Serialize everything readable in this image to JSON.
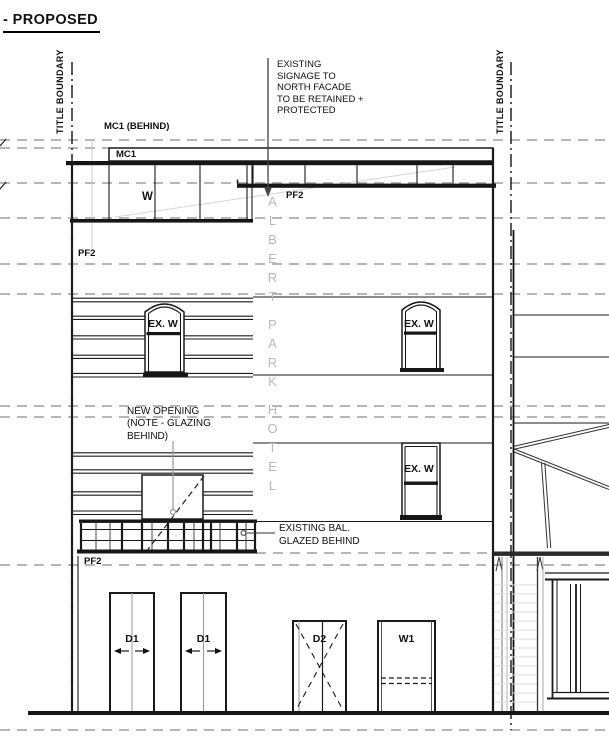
{
  "title": "- PROPOSED",
  "boundary": {
    "left": "TITLE BOUNDARY",
    "right": "TITLE BOUNDARY"
  },
  "notes": {
    "signage": "EXISTING\nSIGNAGE TO\nNORTH FACADE\nTO BE RETAINED +\nPROTECTED",
    "mc1_behind": "MC1 (BEHIND)",
    "new_opening": "NEW OPENING\n(NOTE - GLAZING\nBEHIND)",
    "existing_bal": "EXISTING BAL.\nGLAZED BEHIND"
  },
  "tags": {
    "mc1": "MC1",
    "w": "W",
    "pf2": "PF2",
    "ex_w": "EX. W",
    "d1": "D1",
    "d2": "D2",
    "w1": "W1"
  },
  "building_sign": {
    "word1": "ALBERT",
    "word2": "PARK",
    "word3": "HOTEL"
  },
  "colors": {
    "line": "#1a1a1a",
    "datum_gray": "#9e9e9e",
    "sign_gray": "#b9b9b9"
  }
}
